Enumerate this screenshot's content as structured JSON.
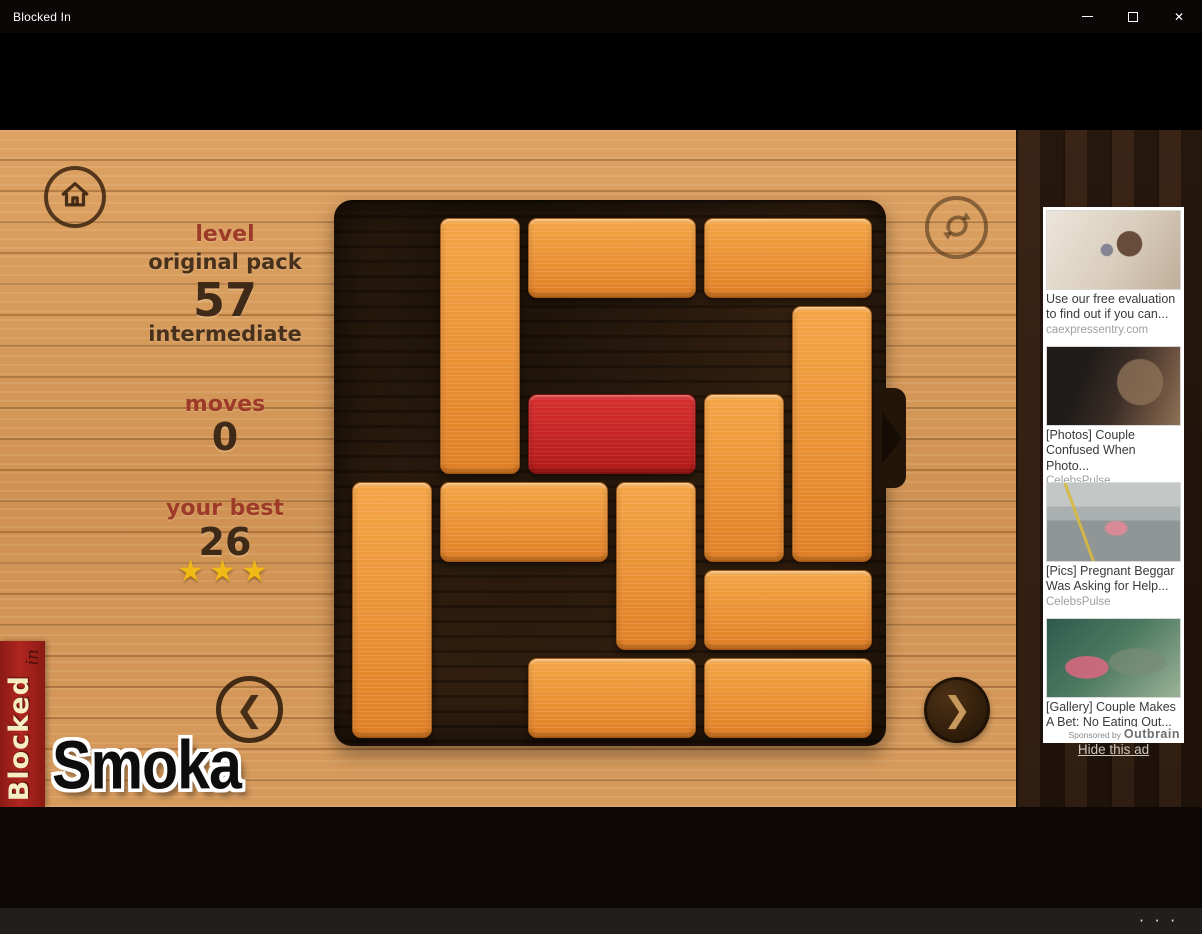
{
  "window": {
    "title": "Blocked In",
    "controls": {
      "close": "✕"
    }
  },
  "hud": {
    "level_label": "level",
    "pack_name": "original pack",
    "level_number": "57",
    "difficulty": "intermediate",
    "moves_label": "moves",
    "moves_value": "0",
    "best_label": "your best",
    "best_value": "26",
    "stars": "★★★",
    "stars_count": 3
  },
  "board": {
    "grid_size": 6,
    "exit_row": 2,
    "exit_side": "right",
    "blocks": [
      {
        "col": 1,
        "row": 0,
        "len": 3,
        "dir": "v",
        "type": "orange"
      },
      {
        "col": 2,
        "row": 0,
        "len": 2,
        "dir": "h",
        "type": "orange"
      },
      {
        "col": 4,
        "row": 0,
        "len": 2,
        "dir": "h",
        "type": "orange"
      },
      {
        "col": 5,
        "row": 1,
        "len": 3,
        "dir": "v",
        "type": "orange"
      },
      {
        "col": 2,
        "row": 2,
        "len": 2,
        "dir": "h",
        "type": "red"
      },
      {
        "col": 4,
        "row": 2,
        "len": 2,
        "dir": "v",
        "type": "orange"
      },
      {
        "col": 0,
        "row": 3,
        "len": 3,
        "dir": "v",
        "type": "orange"
      },
      {
        "col": 1,
        "row": 3,
        "len": 2,
        "dir": "h",
        "type": "orange"
      },
      {
        "col": 3,
        "row": 3,
        "len": 2,
        "dir": "v",
        "type": "orange"
      },
      {
        "col": 4,
        "row": 4,
        "len": 2,
        "dir": "h",
        "type": "orange"
      },
      {
        "col": 2,
        "row": 5,
        "len": 2,
        "dir": "h",
        "type": "orange"
      },
      {
        "col": 4,
        "row": 5,
        "len": 2,
        "dir": "h",
        "type": "orange"
      }
    ]
  },
  "nav": {
    "prev": "❮",
    "next": "❯"
  },
  "branding": {
    "banner_title": "Blocked",
    "banner_sub": "in",
    "watermark": "Smoka"
  },
  "sidebar": {
    "ads": [
      {
        "title": "Use our free evaluation to find out if you can...",
        "source": "caexpressentry.com",
        "image": "woman-holding-passport"
      },
      {
        "title": "[Photos] Couple Confused When Photo...",
        "source": "CelebsPulse",
        "image": "couple-closeup"
      },
      {
        "title": "[Pics] Pregnant Beggar Was Asking for Help...",
        "source": "CelebsPulse",
        "image": "woman-on-road-median"
      },
      {
        "title": "[Gallery] Couple Makes A Bet: No Eating Out...",
        "source": "CelebsPulse",
        "image": "couple-at-aquarium"
      }
    ],
    "sponsored_label": "Sponsored by",
    "sponsored_brand": "Outbrain",
    "hide_ad_label": "Hide this ad"
  },
  "taskbar": {
    "more_icon": "· · ·"
  },
  "colors": {
    "block_orange": "#ed8f33",
    "block_red": "#c62222",
    "star_gold": "#f1b915",
    "banner_red": "#a32019",
    "wood_light": "#d2945a",
    "wood_dark_sidebar": "#281810",
    "board_dark": "#31200f"
  }
}
